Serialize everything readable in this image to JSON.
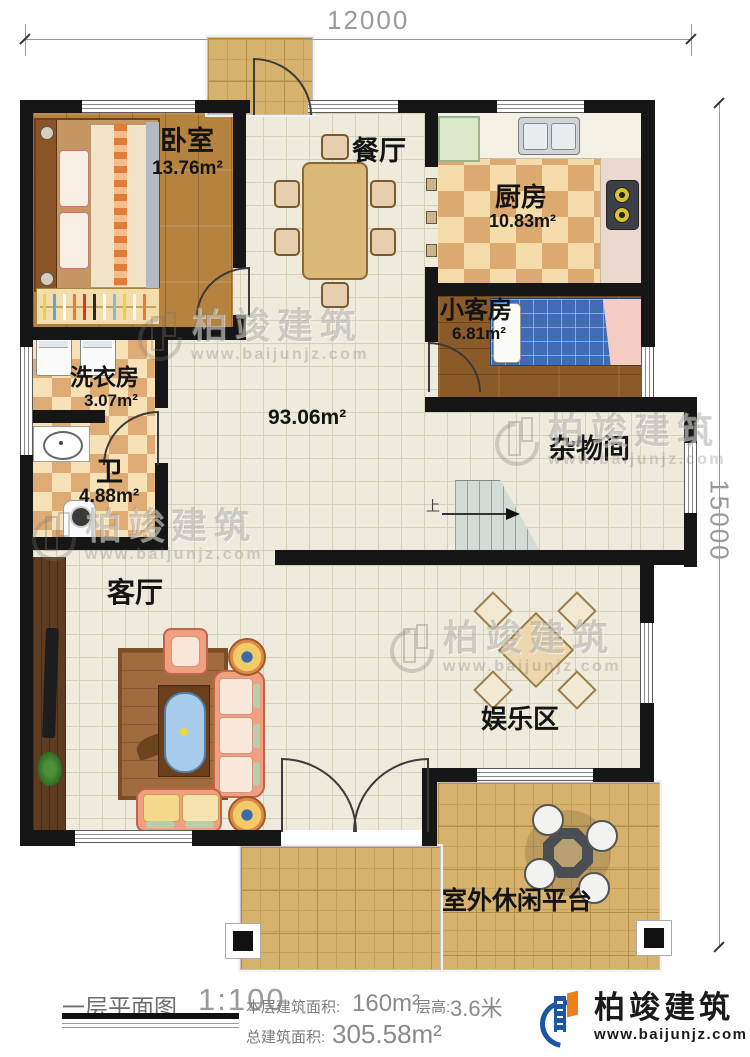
{
  "dimensions": {
    "top": "12000",
    "right": "15000"
  },
  "rooms": {
    "bedroom": {
      "name": "卧室",
      "area": "13.76m²"
    },
    "dining": {
      "name": "餐厅"
    },
    "kitchen": {
      "name": "厨房",
      "area": "10.83m²"
    },
    "guest": {
      "name": "小客房",
      "area": "6.81m²"
    },
    "laundry": {
      "name": "洗衣房",
      "area": "3.07m²"
    },
    "bath": {
      "name": "卫",
      "area": "4.88m²"
    },
    "hall": {
      "area": "93.06m²"
    },
    "storage": {
      "name": "杂物间"
    },
    "living": {
      "name": "客厅"
    },
    "entertainment": {
      "name": "娱乐区"
    },
    "terrace": {
      "name": "室外休闲平台"
    }
  },
  "stairs": {
    "direction": "上"
  },
  "footer": {
    "plan_name": "一层平面图",
    "scale": "1:100",
    "floor_area_label": "本层建筑面积:",
    "floor_area_value": "160m²",
    "storey_height_label": "层高:",
    "storey_height_value": "3.6米",
    "total_area_label": "总建筑面积:",
    "total_area_value": "305.58m²"
  },
  "brand": {
    "name": "柏竣建筑",
    "website": "www.baijunjz.com"
  },
  "watermark": {
    "name": "柏竣建筑",
    "website": "www.baijunjz.com"
  },
  "colors": {
    "wall": "#161616",
    "brand_blue": "#1b55a5",
    "brand_orange": "#ef7f1a"
  }
}
